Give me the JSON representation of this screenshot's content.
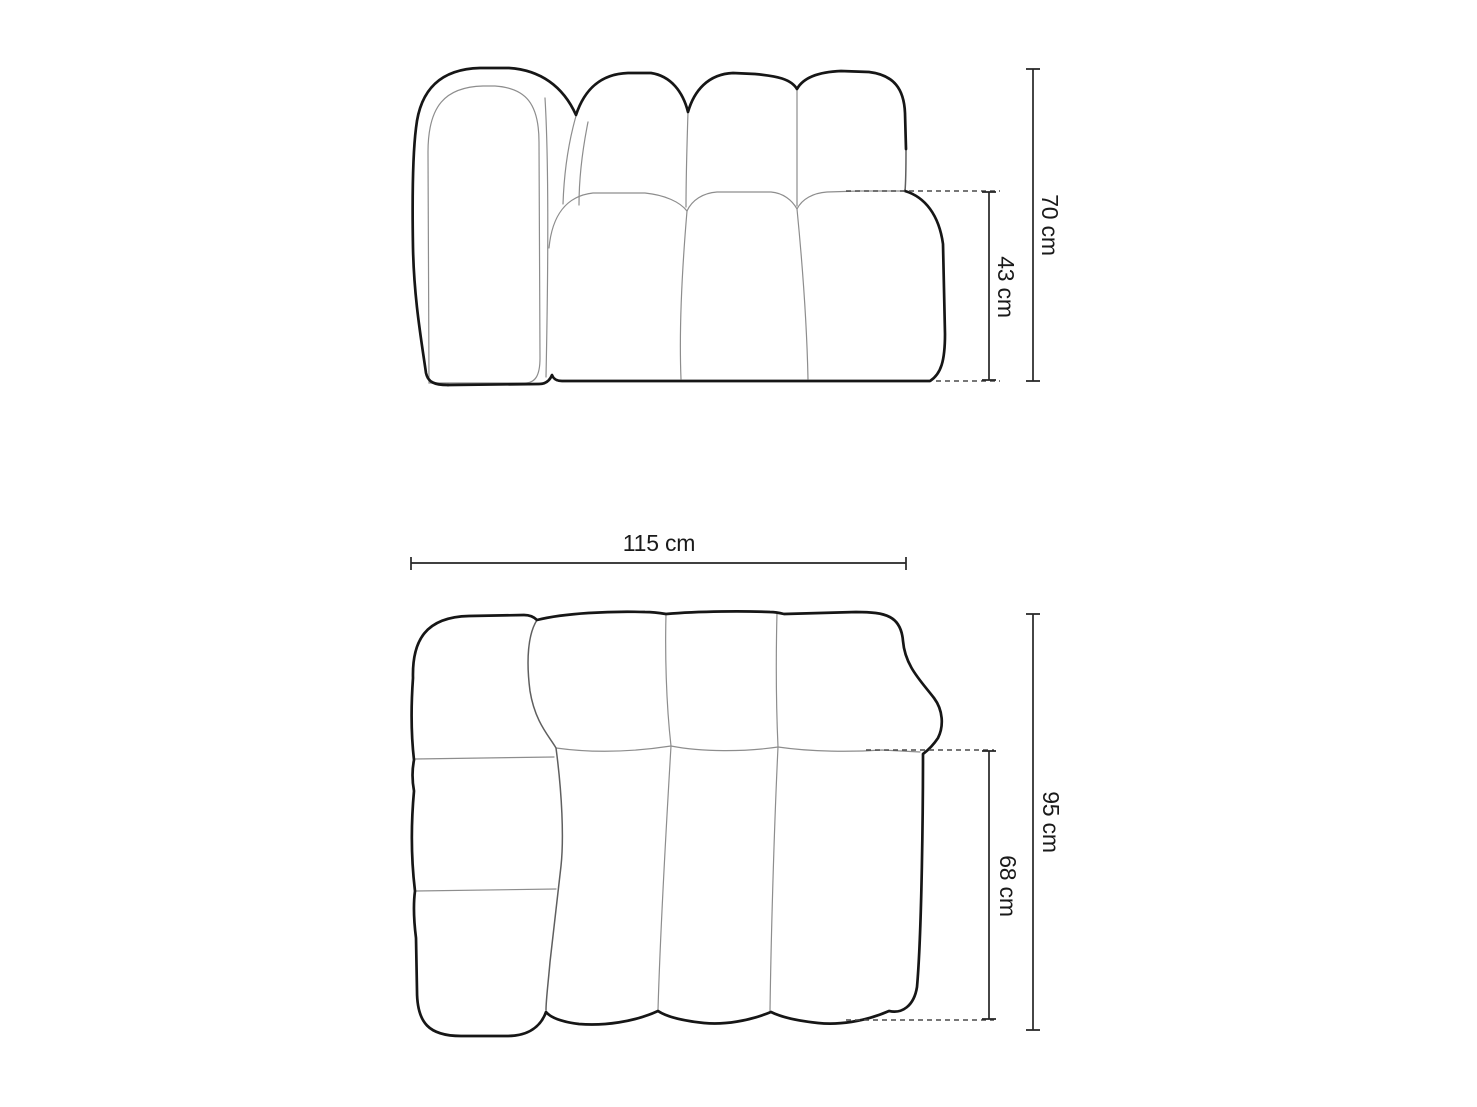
{
  "diagram": {
    "type": "furniture-dimension-drawing",
    "front_view": {
      "dimensions": {
        "total_height": "70 cm",
        "seat_height": "43 cm"
      }
    },
    "top_view": {
      "dimensions": {
        "total_width": "115 cm",
        "total_depth": "95 cm",
        "seat_depth": "68 cm"
      }
    }
  },
  "colors": {
    "background": "#ffffff",
    "outline_bold": "#161616",
    "seam_thin": "#8d8d8d",
    "seam_mid": "#5f5f5f",
    "dashed_extension": "#4a4a4a",
    "dimension_line": "#262626",
    "label_text": "#1a1a1a"
  }
}
